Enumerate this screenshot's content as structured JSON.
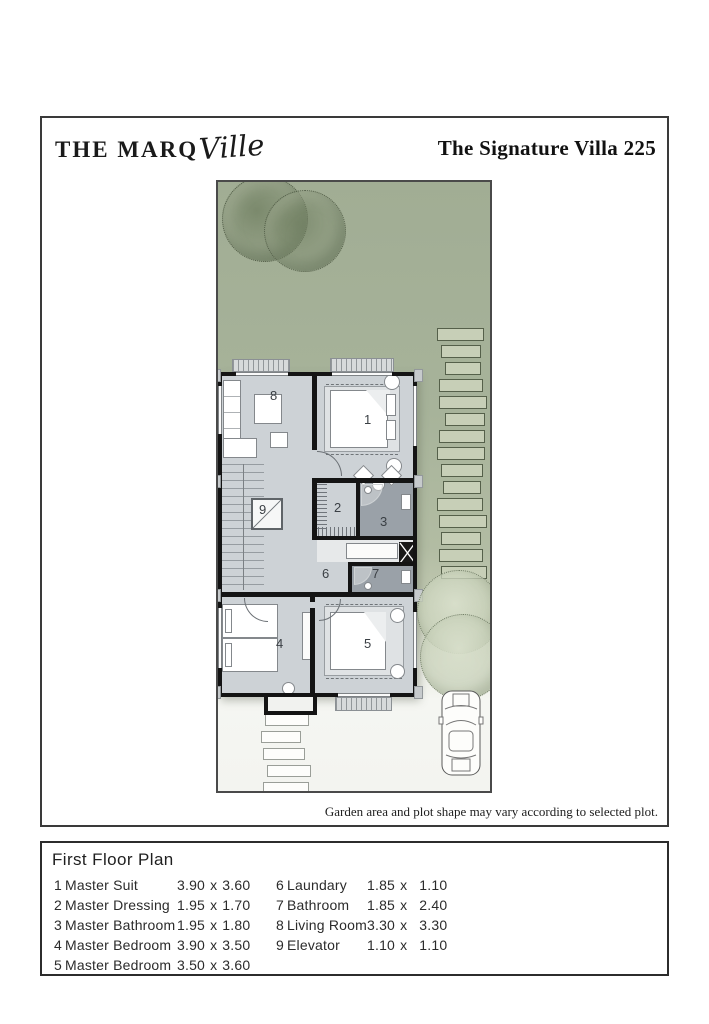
{
  "header": {
    "brand": "THE MARQ",
    "brand_script": "Ville",
    "title": "The Signature Villa 225"
  },
  "plan": {
    "disclaimer": "Garden area and plot shape may vary according to selected plot.",
    "room_numbers": [
      "1",
      "2",
      "3",
      "4",
      "5",
      "6",
      "7",
      "8",
      "9"
    ]
  },
  "legend": {
    "title": "First Floor Plan",
    "separator": "x",
    "columns": [
      [
        {
          "num": "1",
          "name": "Master Suit",
          "w": "3.90",
          "h": "3.60"
        },
        {
          "num": "2",
          "name": "Master Dressing",
          "w": "1.95",
          "h": "1.70"
        },
        {
          "num": "3",
          "name": "Master Bathroom",
          "w": "1.95",
          "h": "1.80"
        },
        {
          "num": "4",
          "name": "Master Bedroom",
          "w": "3.90",
          "h": "3.50"
        },
        {
          "num": "5",
          "name": "Master Bedroom",
          "w": "3.50",
          "h": "3.60"
        }
      ],
      [
        {
          "num": "6",
          "name": "Laundary",
          "w": "1.85",
          "h": "1.10"
        },
        {
          "num": "7",
          "name": "Bathroom",
          "w": "1.85",
          "h": "2.40"
        },
        {
          "num": "8",
          "name": "Living Room",
          "w": "3.30",
          "h": "3.30"
        },
        {
          "num": "9",
          "name": "Elevator",
          "w": "1.10",
          "h": "1.10"
        }
      ]
    ]
  },
  "colors": {
    "garden_green": "#a7b39a",
    "floor_gray": "#cdd2d6",
    "bath_gray": "#9aa1a8",
    "wall_black": "#141414"
  }
}
